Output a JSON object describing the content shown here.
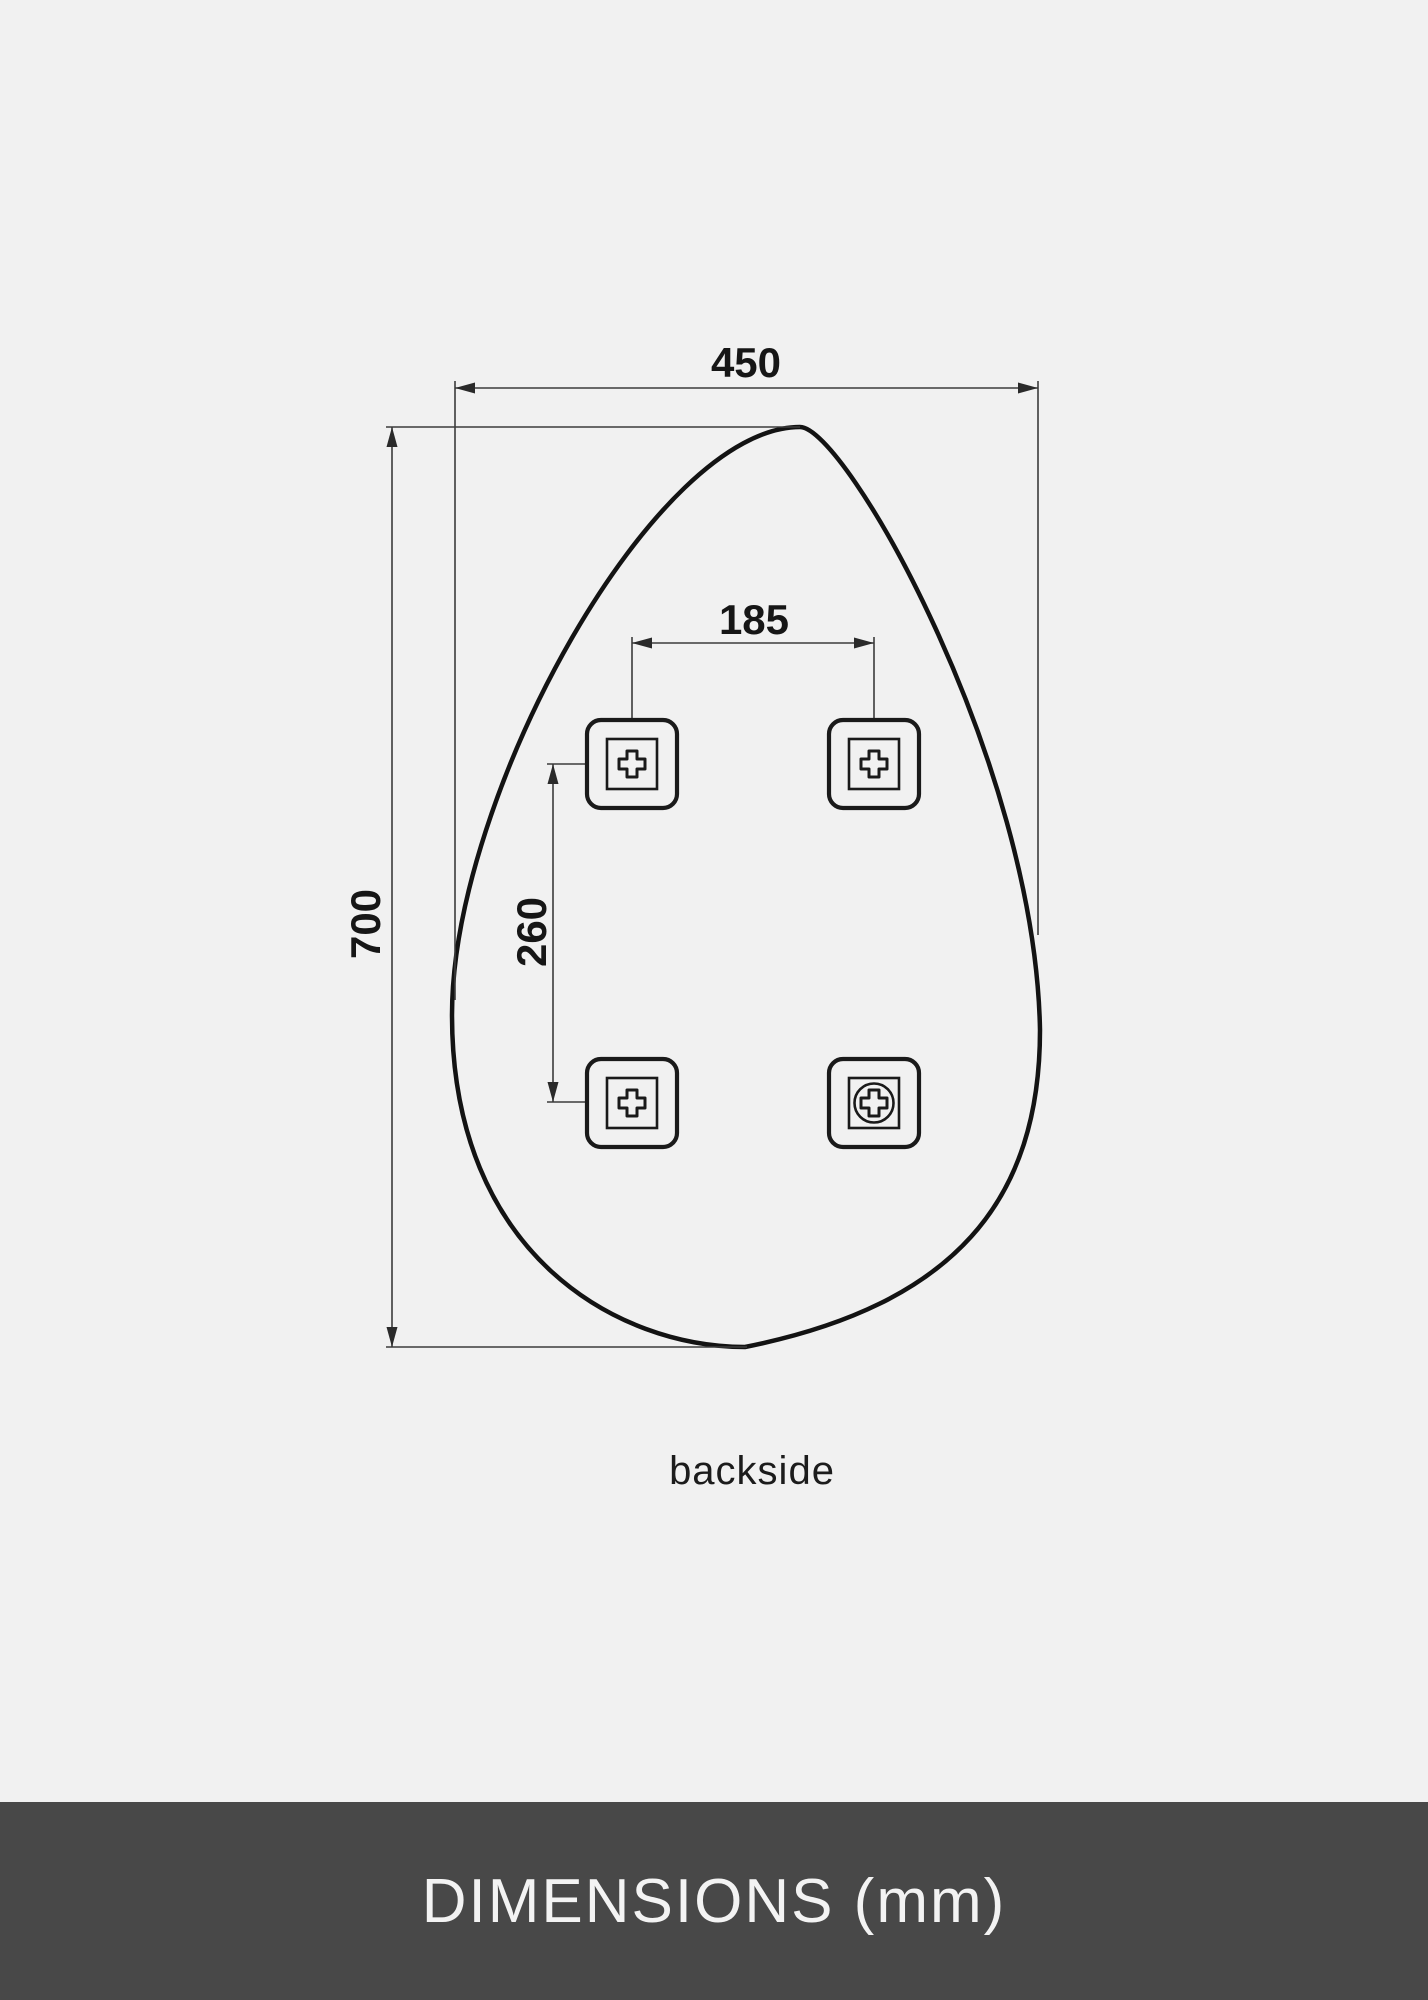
{
  "diagram": {
    "caption": "backside",
    "dimensions": {
      "width_mm": "450",
      "height_mm": "700",
      "bracket_spacing_horizontal_mm": "185",
      "bracket_spacing_vertical_mm": "260"
    },
    "brackets": [
      {
        "position": "top-left",
        "icon": "cross-slot-icon"
      },
      {
        "position": "top-right",
        "icon": "cross-slot-icon"
      },
      {
        "position": "bottom-left",
        "icon": "cross-slot-icon"
      },
      {
        "position": "bottom-right",
        "icon": "screw-head-icon"
      }
    ],
    "colors": {
      "background": "#f1f1f1",
      "shape_outline": "#131313",
      "dimension_lines": "#3c3c3c",
      "text": "#161616"
    }
  },
  "banner": {
    "title": "DIMENSIONS (mm)",
    "background": "#484848",
    "text_color": "#f3f3f3"
  }
}
